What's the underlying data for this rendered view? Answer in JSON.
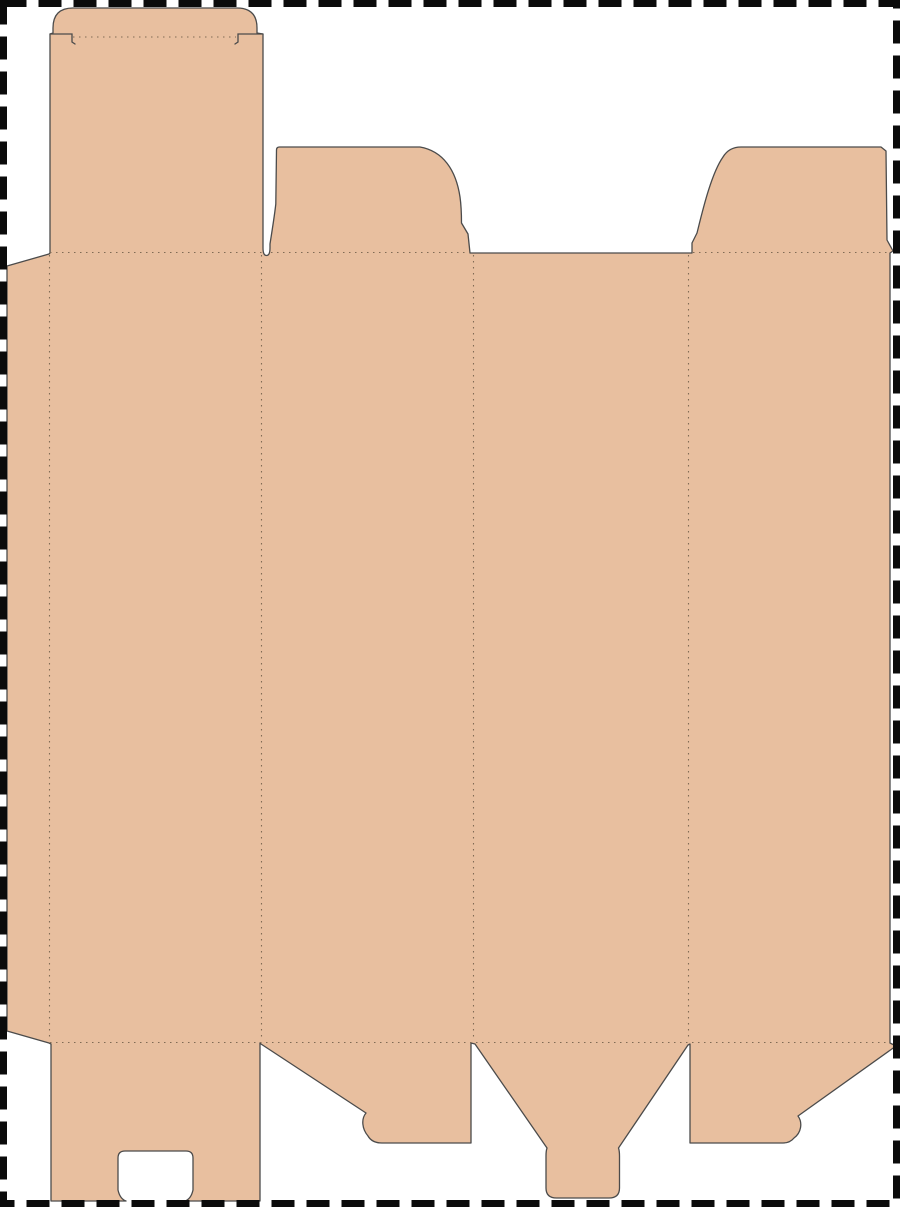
{
  "canvas": {
    "width": 900,
    "height": 1207
  },
  "colors": {
    "background": "#ffffff",
    "card_fill": "#e8bf9f",
    "cut_line": "#4b4b4b",
    "fold_line": "#806b55",
    "trim_border": "#0b0b0b"
  },
  "trim_border": {
    "dash_pattern": "23 12",
    "thickness": "7"
  },
  "fold_style": {
    "dash_pattern": "1.5 4.5",
    "thickness": "1.1"
  },
  "cut_style": {
    "thickness": "1.3"
  },
  "paths": {
    "outline": "M 53 28 Q 53 8 73 8 L 237 8 Q 257 8 257 28 L 257 33 L 263 34 L 263 248 Q 263 255.5 266.5 255.5 Q 270 255.5 270 248 L 270 244 C 272 231 274.5 216 275.8 204 L 276.5 150 Q 276.5 147 279.5 147 L 420 147 C 443 151 456 170 460 197 C 461 204 461.5 215 461.5 223 L 468 234 L 470 253 L 692 253 L 692 243 L 697 233 C 702 213 711 174 723 157 Q 729 147 741 147 L 881 147 L 886 151 L 887 240 L 893 251 L 890 253 L 890 1043 L 896 1046 L 798 1116 C 803 1123 801 1133 794 1138 Q 790 1143 783 1143 L 690 1143 L 690 1044 L 688 1045 L 618.5 1148 Q 619.5 1151 619.5 1156 L 619.5 1188 Q 619.5 1198 609 1198 L 556.5 1198 Q 546 1198 546 1188 L 546 1156 Q 546 1151 547 1148 L 475 1044 L 471 1043 L 471 1143 L 382 1143 Q 372 1143 368 1136 C 362 1129 361 1119 366 1113 L 261 1044 L 260 1043 L 260 1201 L 185 1201 Q 191 1199 193 1190 L 193 1158 Q 193 1151 186 1151 L 125 1151 Q 118 1151 118 1158 L 118 1190 Q 120 1199 126 1201 L 51 1201 L 51 1044 L 49 1043 L 7 1031 L 7 266 L 49 254 L 50 253 L 50 34 L 53 33 Z",
    "tuck_slits": "M 50 34 L 72 34 L 72 42 L 75 44 M 263 34 L 238 34 L 238 42 L 235 44",
    "fold_lines": "M 73 37 L 236 37 M 50 252.5 L 262 252.5 M 271 252.5 L 468 252.5 M 693 252.5 L 889 252.5 M 50 1042.5 L 889 1042.5 M 49.5 255 L 49.5 1041 M 261.5 255 L 261.5 1041 M 473.5 255 L 473.5 1041 M 688.5 255 L 688.5 1041"
  }
}
